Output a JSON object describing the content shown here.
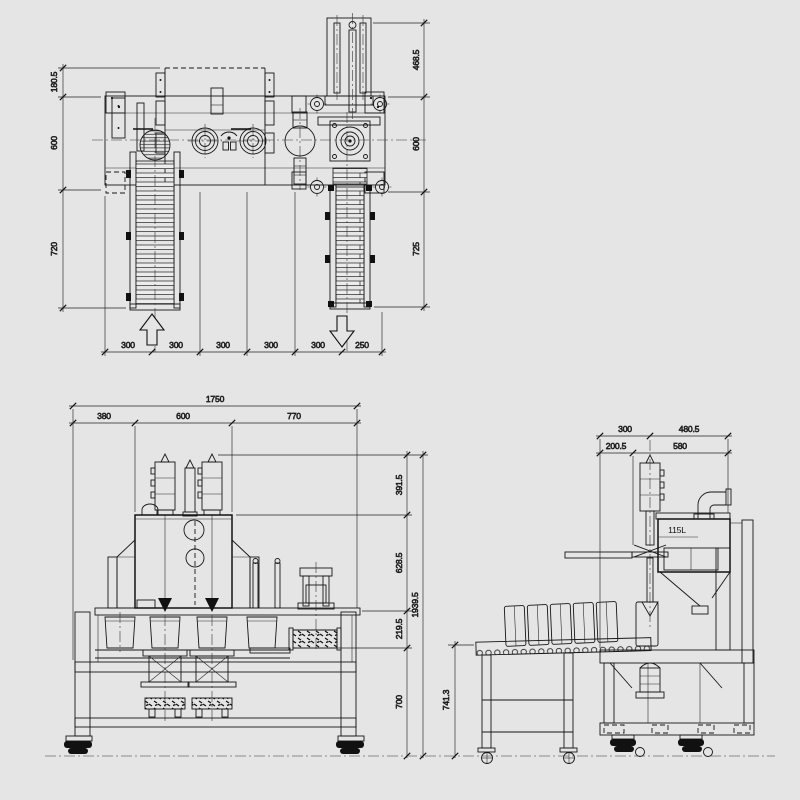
{
  "drawing": {
    "background_color": "#e5e5e5",
    "line_color": "#161616",
    "top_view": {
      "left_dims": [
        "180.5",
        "600",
        "720"
      ],
      "right_dims": [
        "468.5",
        "600",
        "725"
      ],
      "bottom_dims": [
        "300",
        "300",
        "300",
        "300",
        "300",
        "250"
      ]
    },
    "front_view": {
      "overall_width": "1750",
      "top_dims": [
        "380",
        "600",
        "770"
      ],
      "right_dims": [
        "391.5",
        "628.5",
        "219.5",
        "700"
      ],
      "overall_height": "1939.5"
    },
    "side_view": {
      "top_dims_row1": [
        "300",
        "480.5"
      ],
      "top_dims_row2": [
        "200.5",
        "580"
      ],
      "height_dim": "741.3",
      "tank_capacity_label": "115L"
    }
  }
}
